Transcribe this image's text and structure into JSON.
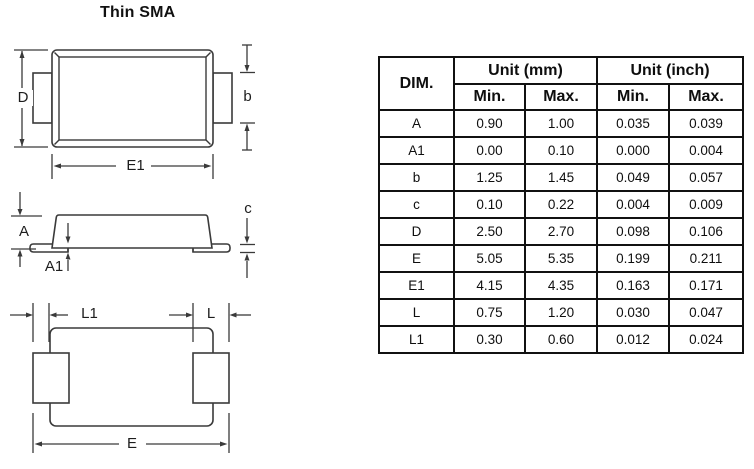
{
  "title": "Thin SMA",
  "colors": {
    "background": "#ffffff",
    "drawing_line": "#3a3a3a",
    "text": "#111111",
    "table_border": "#111111"
  },
  "drawing": {
    "views": [
      "top-view",
      "side-view",
      "bottom-view"
    ],
    "labels": {
      "d": "D",
      "b": "b",
      "e1": "E1",
      "a": "A",
      "a1": "A1",
      "c": "c",
      "l1": "L1",
      "l": "L",
      "e": "E"
    }
  },
  "table": {
    "headers": {
      "dim": "DIM.",
      "unit_mm": "Unit (mm)",
      "unit_inch": "Unit (inch)",
      "min": "Min.",
      "max": "Max."
    },
    "rows": [
      {
        "dim": "A",
        "mm_min": "0.90",
        "mm_max": "1.00",
        "inch_min": "0.035",
        "inch_max": "0.039"
      },
      {
        "dim": "A1",
        "mm_min": "0.00",
        "mm_max": "0.10",
        "inch_min": "0.000",
        "inch_max": "0.004"
      },
      {
        "dim": "b",
        "mm_min": "1.25",
        "mm_max": "1.45",
        "inch_min": "0.049",
        "inch_max": "0.057"
      },
      {
        "dim": "c",
        "mm_min": "0.10",
        "mm_max": "0.22",
        "inch_min": "0.004",
        "inch_max": "0.009"
      },
      {
        "dim": "D",
        "mm_min": "2.50",
        "mm_max": "2.70",
        "inch_min": "0.098",
        "inch_max": "0.106"
      },
      {
        "dim": "E",
        "mm_min": "5.05",
        "mm_max": "5.35",
        "inch_min": "0.199",
        "inch_max": "0.211"
      },
      {
        "dim": "E1",
        "mm_min": "4.15",
        "mm_max": "4.35",
        "inch_min": "0.163",
        "inch_max": "0.171"
      },
      {
        "dim": "L",
        "mm_min": "0.75",
        "mm_max": "1.20",
        "inch_min": "0.030",
        "inch_max": "0.047"
      },
      {
        "dim": "L1",
        "mm_min": "0.30",
        "mm_max": "0.60",
        "inch_min": "0.012",
        "inch_max": "0.024"
      }
    ]
  }
}
